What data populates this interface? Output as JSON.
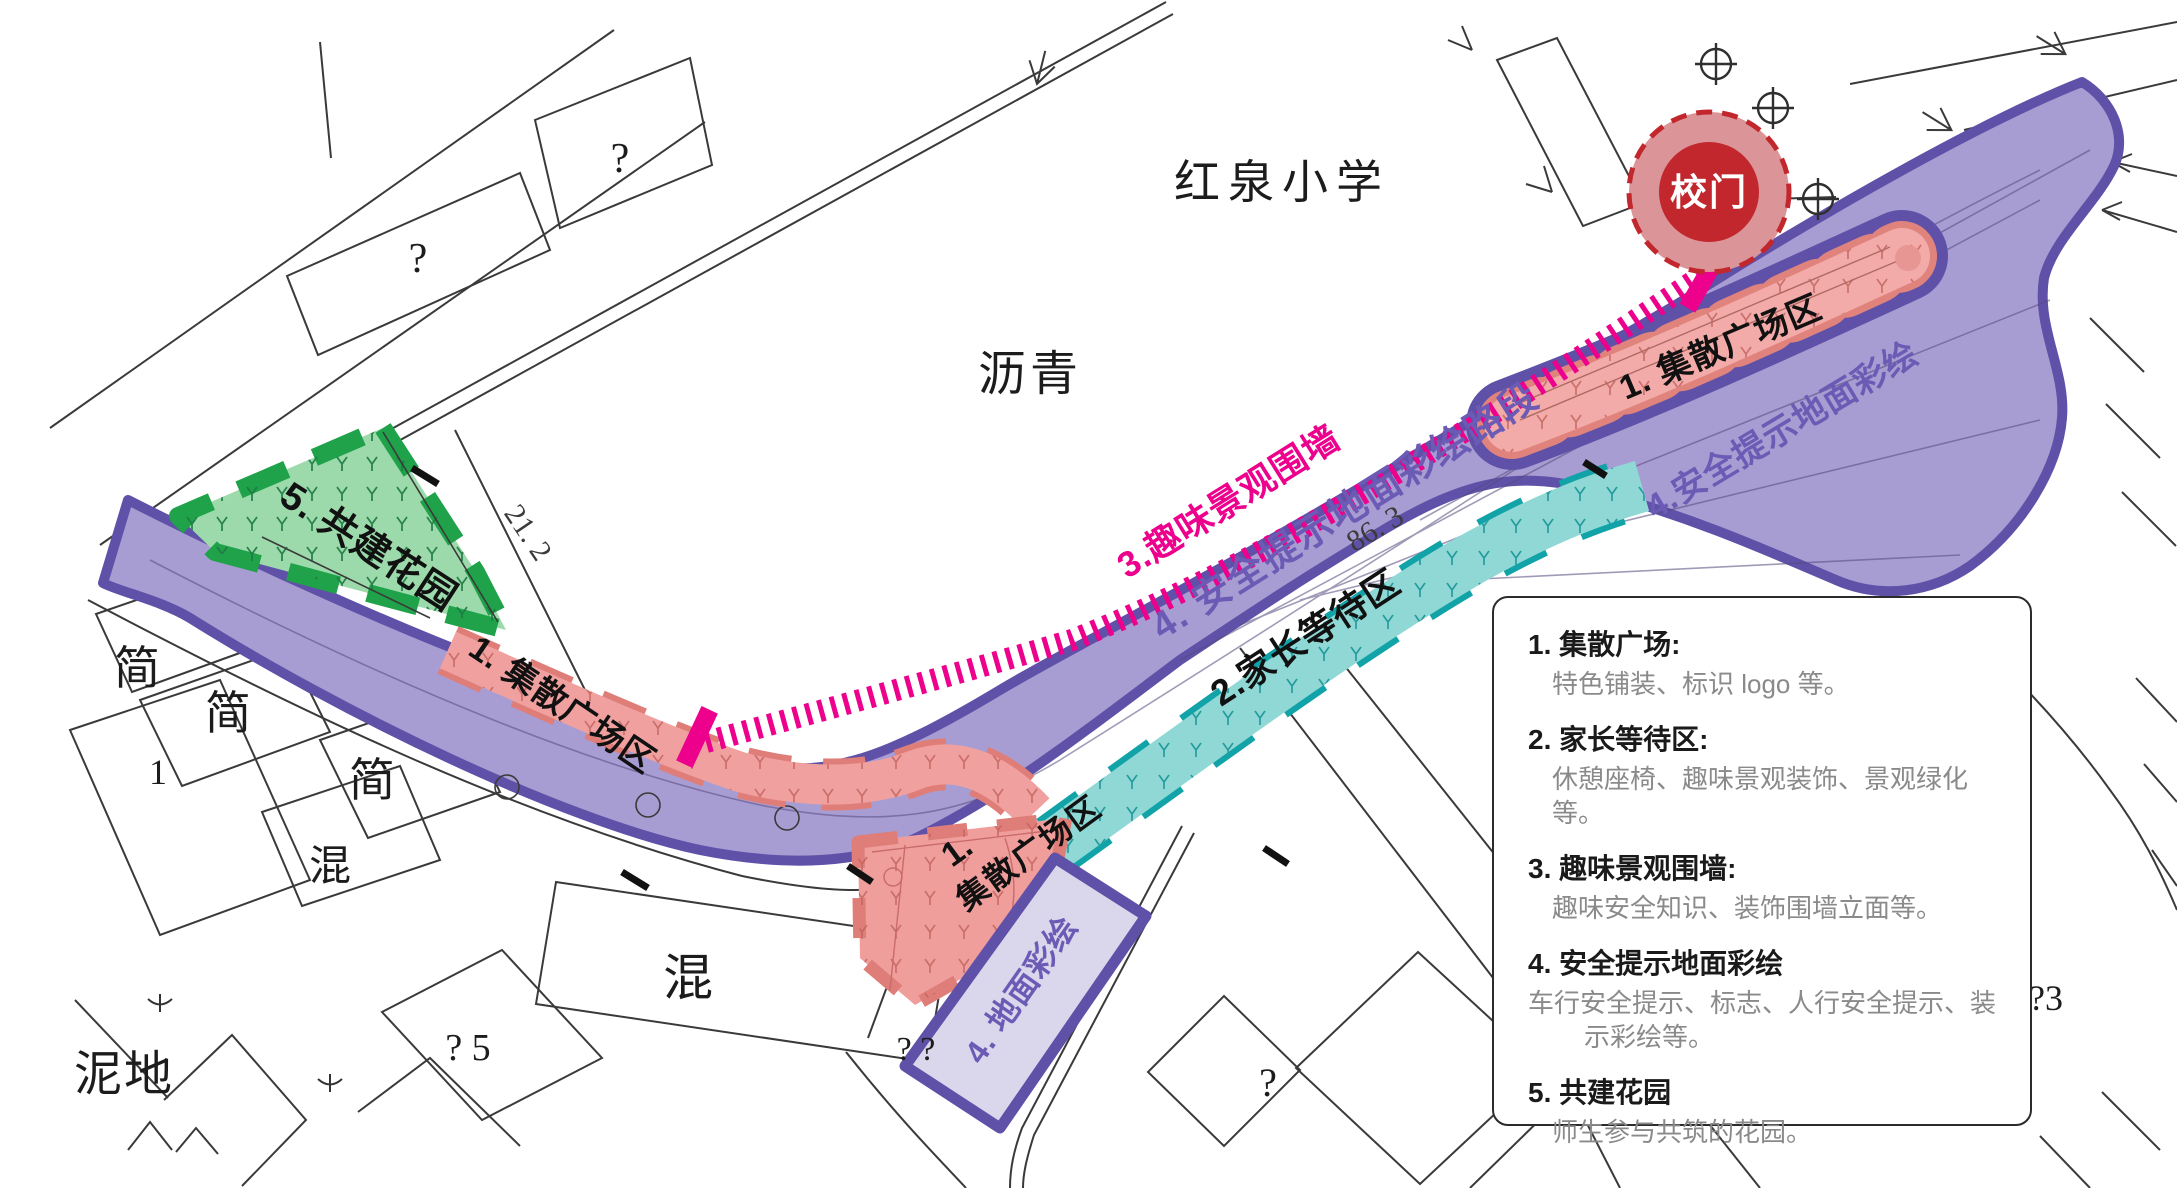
{
  "map": {
    "school_name": "红泉小学",
    "surface_asphalt": "沥青",
    "surface_mud": "泥地",
    "surface_mixed_a": "混",
    "surface_mixed_b": "混",
    "surface_simple_a": "简",
    "surface_simple_b": "简",
    "surface_simple_c": "简",
    "lot_number": "1",
    "building_mark_1": "?",
    "building_mark_2": "?",
    "building_mark_3": "?",
    "building_mark_4": "? 5",
    "building_mark_5": "? ?",
    "building_mark_6": "?3",
    "dim_a": "21. 2",
    "dim_b": "86. 3"
  },
  "zones": {
    "gate_label": "校门",
    "plaza_top_right": "1. 集散广场区",
    "ground_paint_top_right": "4.安全提示地面彩绘",
    "wall_label": "3.趣味景观围墙",
    "road_paint_label": "4. 安全提示地面彩绘路段",
    "waiting_label": "2.家长等待区",
    "plaza_left": "1. 集散广场区",
    "plaza_bottom_num": "1.",
    "plaza_bottom_name": "集散广场区",
    "ground_paint_bottom": "4. 地面彩绘",
    "garden_label": "5. 共建花园"
  },
  "legend": {
    "items": [
      {
        "num": "1.",
        "title": "集散广场:",
        "desc": "特色铺装、标识 logo 等。"
      },
      {
        "num": "2.",
        "title": "家长等待区:",
        "desc": "休憩座椅、趣味景观装饰、景观绿化等。"
      },
      {
        "num": "3.",
        "title": "趣味景观围墙:",
        "desc": "趣味安全知识、装饰围墙立面等。"
      },
      {
        "num": "4.",
        "title": "安全提示地面彩绘",
        "desc": "车行安全提示、标志、人行安全提示、装示彩绘等。"
      },
      {
        "num": "5.",
        "title": "共建花园",
        "desc": "师生参与共筑的花园。"
      }
    ]
  },
  "colors": {
    "band_fill": "#a89dd2",
    "band_border": "#5f51a8",
    "label_purple": "#6c5bb5",
    "magenta": "#ec008c",
    "zone_red_fill": "#f0a19f",
    "zone_red_edge": "#df7e78",
    "cyan_fill": "#8fd8d5",
    "cyan_edge": "#12a3a8",
    "green_fill": "#9cdaab",
    "green_edge": "#1fa24a",
    "gate_inner": "#c1272d",
    "gate_outer": "#db9598",
    "lavender_fill": "#dad6ec",
    "linework": "#3a3a3a",
    "legend_desc_gray": "#8a8a8a"
  }
}
